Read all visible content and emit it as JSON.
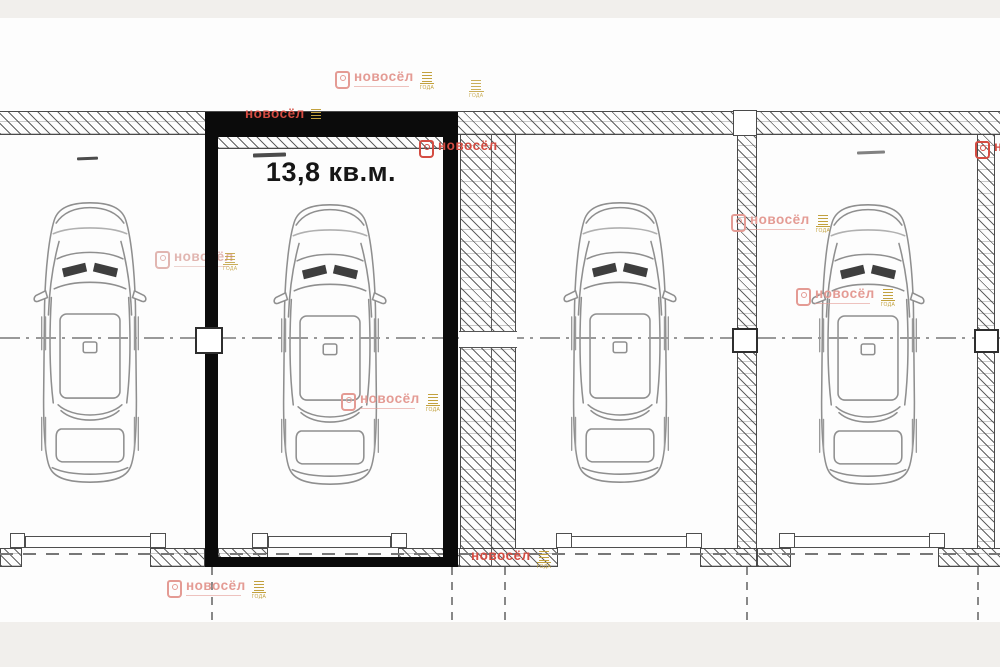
{
  "plan": {
    "area_label": "13,8 кв.м.",
    "stall_count": 4,
    "stalls": [
      {
        "name": "stall-1",
        "highlighted": false,
        "has_car": true,
        "area_label": ""
      },
      {
        "name": "stall-2",
        "highlighted": true,
        "has_car": true,
        "area_label": "13,8 кв.м."
      },
      {
        "name": "stall-3",
        "highlighted": false,
        "has_car": true,
        "area_label": ""
      },
      {
        "name": "stall-4",
        "highlighted": false,
        "has_car": true,
        "area_label": ""
      }
    ]
  },
  "watermark": {
    "brand": "новосёл",
    "award_label": "ГОДА",
    "color_light": "#e49b94",
    "color_faint": "#ddaaa4",
    "color_bright": "#d44c42",
    "color_gold": "#c2a13e"
  },
  "colors": {
    "background": "#ffffff",
    "band_gray": "#f1efec",
    "wall_line": "#4a4a4a",
    "car_line": "#8f8f8f",
    "centerline": "#999999",
    "highlight_border": "#0b0b0b",
    "label_text": "#161616"
  }
}
